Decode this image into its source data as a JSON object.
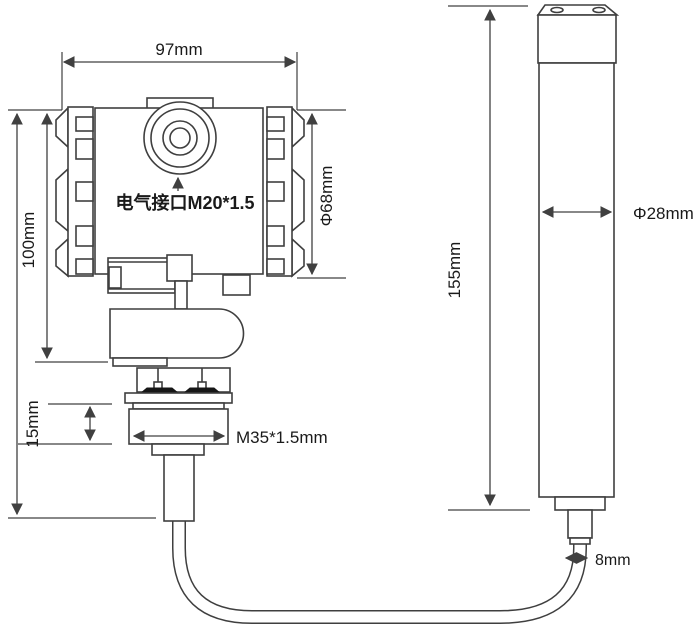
{
  "diagram": {
    "background": "#ffffff",
    "line_color": "#3f3f3f",
    "text_color": "#1a1a1a",
    "labels": {
      "top_width": "97mm",
      "body_height": "100mm",
      "thread_height": "15mm",
      "body_diameter": "Φ68mm",
      "electrical_port": "电气接口M20*1.5",
      "thread_spec": "M35*1.5mm",
      "probe_length": "155mm",
      "probe_diameter": "Φ28mm",
      "cable_diameter": "8mm"
    }
  }
}
